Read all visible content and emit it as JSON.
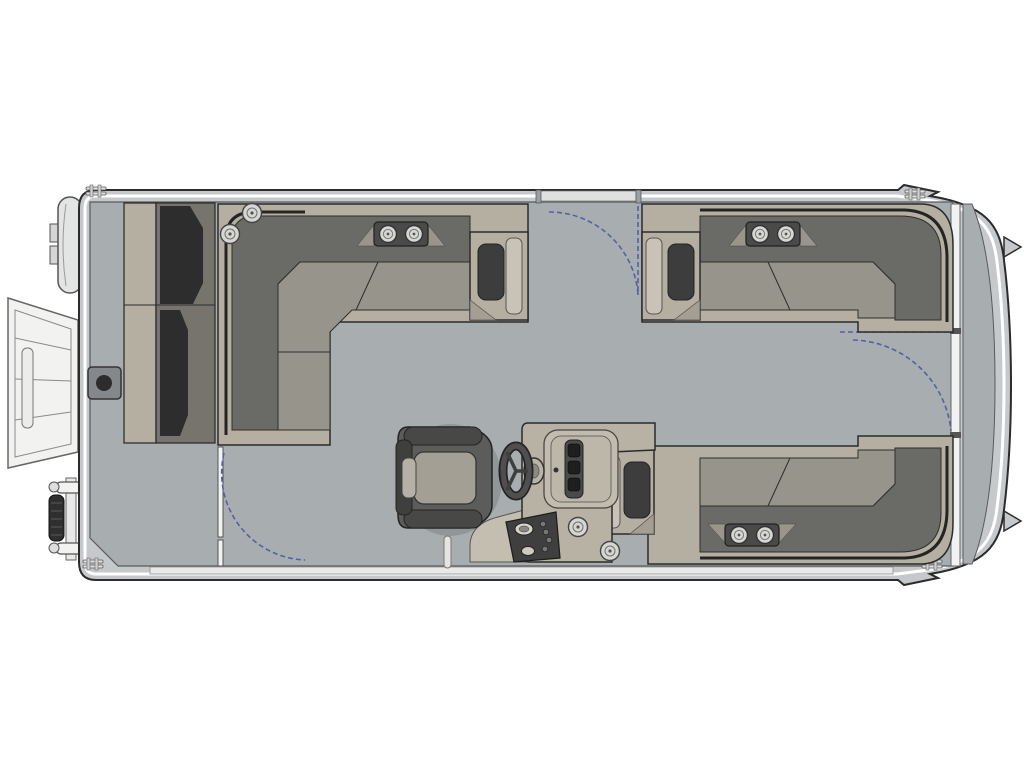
{
  "diagram": {
    "type": "floor-plan",
    "subject": "pontoon-boat-top-view",
    "orientation": {
      "bow": "left",
      "stern": "right",
      "starboard": "top",
      "port": "bottom"
    },
    "visible_text": []
  },
  "palette": {
    "background": "#ffffff",
    "outline": "#2b2b2b",
    "hull_band": "#c6c9cb",
    "hull_stripe": "#ffffff",
    "deck": "#a8adb0",
    "fence": "#f1f2f2",
    "rail_band": "#e8eaea",
    "seat_base_tan": "#b5afa2",
    "seat_cushion": "#97948b",
    "seat_cushion_light": "#c9c3b7",
    "back_cushion": "#6a6a67",
    "back_shadow": "#242424",
    "cushion_dark": "#3d3d3d",
    "bench_seat": "#76746d",
    "console_body": "#b8b2a5",
    "console_light": "#c4beb1",
    "panel_dark": "#3f3f3f",
    "chair_body": "#5c5c5a",
    "chair_trim": "#484846",
    "chair_cushion": "#a39f94",
    "cup_face": "#d6d6d2",
    "metal_white": "#f2f2f1",
    "mount_gray": "#84888c",
    "swing_arc": "#5560a5"
  },
  "components": {
    "floor_plan": {
      "label": "Pontoon boat floor plan, top-down view, bow at left"
    },
    "hull": {
      "label": "Pontoon hull with side rails"
    },
    "deck": {
      "label": "Main deck"
    },
    "stern_platform": {
      "label": "Stern boarding platform strip"
    },
    "bow_ramp": {
      "label": "Bow boarding gate ramp shown open"
    },
    "bow_ladder": {
      "label": "Folded boarding ladder on port bow"
    },
    "bow_pod": {
      "label": "Bow pod fitting"
    },
    "ski_tow_mount": {
      "label": "Deck mount fitting with socket"
    },
    "bow_bench": {
      "label": "Bow bench seat"
    },
    "forward_lounge": {
      "label": "Forward L-shaped lounge, starboard bow"
    },
    "starboard_lounge": {
      "label": "Starboard aft L-shaped lounge"
    },
    "aft_lounge": {
      "label": "Port aft L-shaped lounge"
    },
    "helm_console": {
      "label": "Helm console with dash and gauges"
    },
    "steering_wheel": {
      "label": "Steering wheel"
    },
    "captains_chair": {
      "label": "Captain's swivel chair"
    },
    "grab_post": {
      "label": "Deck post"
    },
    "gate_starboard": {
      "label": "Starboard side gate with swing arc"
    },
    "gate_stern": {
      "label": "Stern gate with swing arc"
    },
    "gate_port": {
      "label": "Port side gate shown open with swing arc"
    },
    "cup_holder": {
      "label": "Cup holder"
    },
    "cup_holder_module": {
      "label": "Twin cup holder module"
    },
    "hinge": {
      "label": "Rail hinge fitting"
    }
  },
  "counts": {
    "cup_holders": 10,
    "swing_gates": 3,
    "lounges": 3,
    "helm_seats": 1,
    "benches": 1
  }
}
